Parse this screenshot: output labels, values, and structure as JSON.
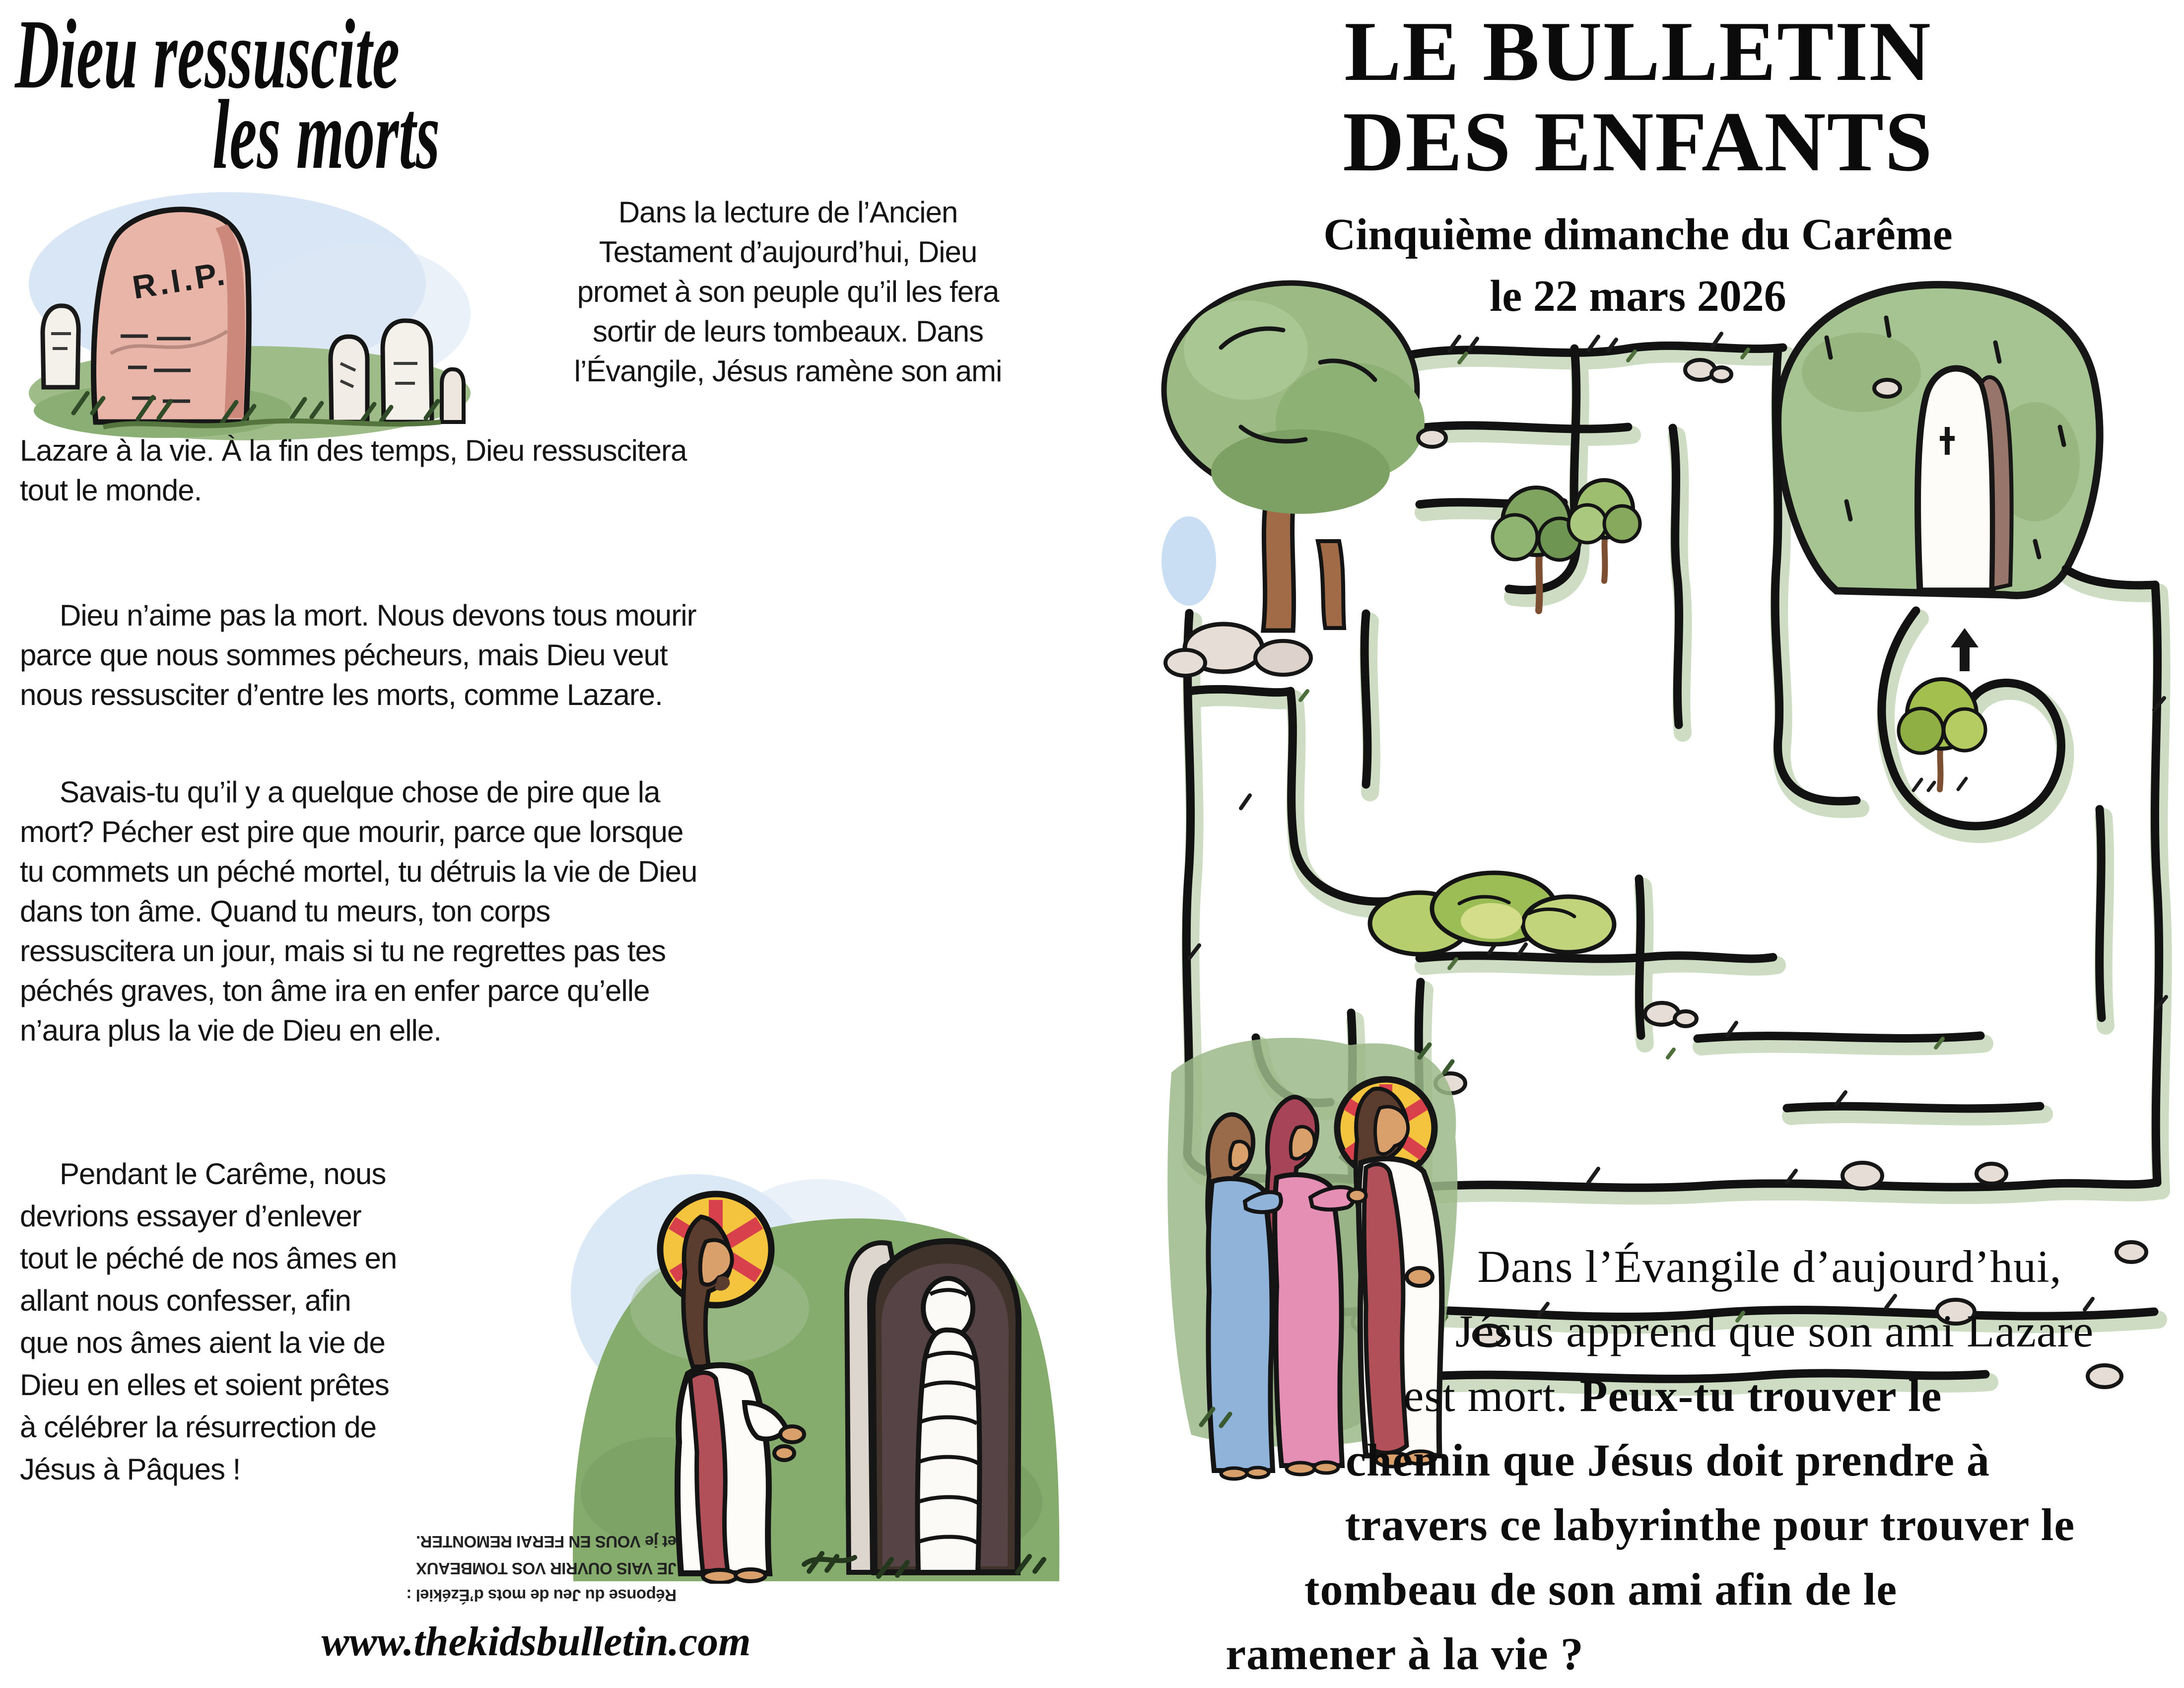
{
  "left_page": {
    "title": {
      "line1": "Dieu ressuscite",
      "line2": "les morts"
    },
    "rip_label": "R.I.P.",
    "para1_side_lines": [
      "Dans la lecture de l’Ancien",
      "Testament d’aujourd’hui, Dieu",
      "promet à son peuple qu’il les fera",
      "sortir de leurs tombeaux. Dans",
      "l’Évangile, Jésus ramène son ami"
    ],
    "para1_full_lines": [
      "Lazare à la vie. À la fin des temps, Dieu ressuscitera",
      "tout le monde."
    ],
    "para2_lines": [
      "Dieu n’aime pas la mort. Nous devons tous mourir",
      "parce que nous sommes pécheurs, mais Dieu veut",
      "nous ressusciter d’entre les morts, comme Lazare."
    ],
    "para3_lines": [
      "Savais-tu qu’il y a quelque chose de pire que la",
      "mort? Pécher est pire que mourir, parce que lorsque",
      "tu commets un péché mortel, tu détruis la vie de Dieu",
      "dans ton âme. Quand tu meurs, ton corps",
      "ressuscitera un jour, mais si tu ne regrettes pas tes",
      "péchés graves, ton âme ira en enfer parce qu’elle",
      "n’aura plus la vie de Dieu en elle."
    ],
    "para4_lines": [
      "Pendant le Carême, nous",
      "devrions essayer d’enlever",
      "tout le péché de nos âmes en",
      "allant nous confesser, afin",
      "que nos âmes aient la vie de",
      "Dieu en elles et soient prêtes",
      "à célébrer la résurrection de",
      "Jésus à Pâques !"
    ],
    "answer": {
      "line1": "Réponse du Jeu de mots d’Ézékiel :",
      "line2": "JE VAIS OUVRIR VOS TOMBEAUX",
      "line3": "et je VOUS EN FERAI REMONTER."
    },
    "website": "www.thekidsbulletin.com"
  },
  "right_page": {
    "title_line1": "LE BULLETIN",
    "title_line2": "DES ENFANTS",
    "subtitle": "Cinquième dimanche du Carême",
    "date": "le 22 mars 2026",
    "caption": {
      "line1": "Dans l’Évangile d’aujourd’hui,",
      "line2": "Jésus apprend que son ami Lazare",
      "line3_regular": "est mort. ",
      "line3_bold": "Peux-tu trouver le",
      "line4": "chemin que Jésus doit prendre à",
      "line5": "travers ce labyrinthe pour trouver le",
      "line6": "tombeau de son ami afin de le",
      "line7": "ramener à la vie ?"
    }
  },
  "illustrations": {
    "tombstones": "rip-tombstones-illustration",
    "jesus_lazarus": "jesus-raising-lazarus-illustration",
    "maze": "labyrinth-to-tomb-illustration",
    "jesus_group": "jesus-with-mary-and-martha-figures",
    "entrance_arrow": "maze-entrance-arrow"
  },
  "colors": {
    "ink": "#141414",
    "stone_pink": "#e9b5a9",
    "grass_green": "#8fb07a",
    "halo_yellow": "#f5c43e",
    "halo_ray_red": "#d8414b",
    "sash_red": "#b2505a",
    "dress_pink": "#e58fb4",
    "dress_blue": "#8fb3d9",
    "sky_blue": "#cfe0f3"
  }
}
